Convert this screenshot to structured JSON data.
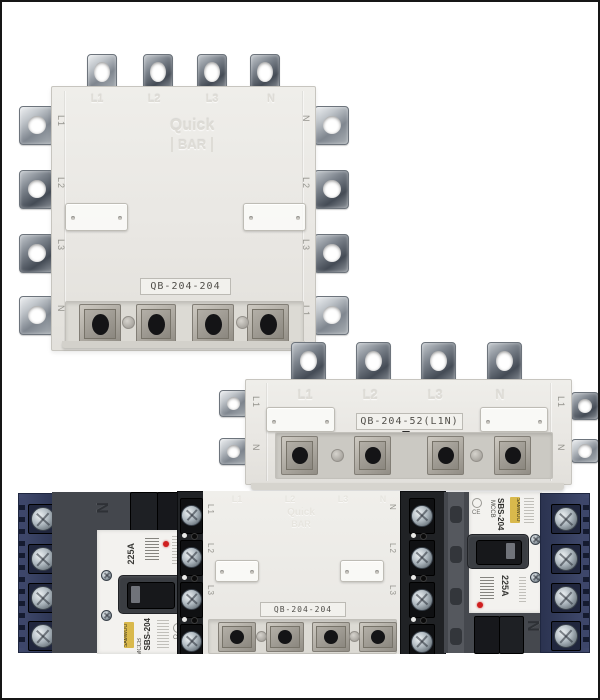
{
  "top_device": {
    "model": "QB-204-204",
    "emboss_line1": "Quick",
    "emboss_line2": "BAR",
    "top_terminals": [
      "L1",
      "L2",
      "L3",
      "N"
    ],
    "left_terminals": [
      "L1",
      "L2",
      "L3",
      "N"
    ],
    "right_terminals": [
      "N",
      "L2",
      "L3",
      "L1"
    ]
  },
  "middle_device": {
    "model": "QB-204-52(L1N)",
    "top_terminals": [
      "L1",
      "L2",
      "L3",
      "N"
    ],
    "left_terminals": [
      "L1",
      "N"
    ],
    "right_terminals": [
      "L1",
      "N"
    ]
  },
  "bottom_assembly": {
    "center_model": "QB-204-204",
    "center_emboss_line1": "Quick",
    "center_emboss_line2": "BAR",
    "center_top_terminals": [
      "L1",
      "L2",
      "L3",
      "N"
    ],
    "center_left_terminals": [
      "L1",
      "L2",
      "L3",
      "N"
    ],
    "center_right_terminals": [
      "N",
      "L2",
      "L3",
      "L1"
    ],
    "left_breaker": {
      "brand": "SAMWOO",
      "type": "MCCB",
      "model": "SBS-204",
      "rating": "225A",
      "pole_mark": "N",
      "cert_mark": "CE"
    },
    "right_breaker": {
      "brand": "SAMWOO",
      "type": "MCCB",
      "model": "SBS-204",
      "rating": "225A",
      "pole_mark": "N",
      "cert_mark": "CE"
    }
  },
  "colors": {
    "device_body": "#eae8e4",
    "metal": "#9aa0a6",
    "indicator_red": "#cf1f1f",
    "breaker_dark": "#44474d",
    "terminal_navy": "#3b4467",
    "label_text": "#514f4a",
    "brand_tag_yellow": "#d9b94c"
  }
}
